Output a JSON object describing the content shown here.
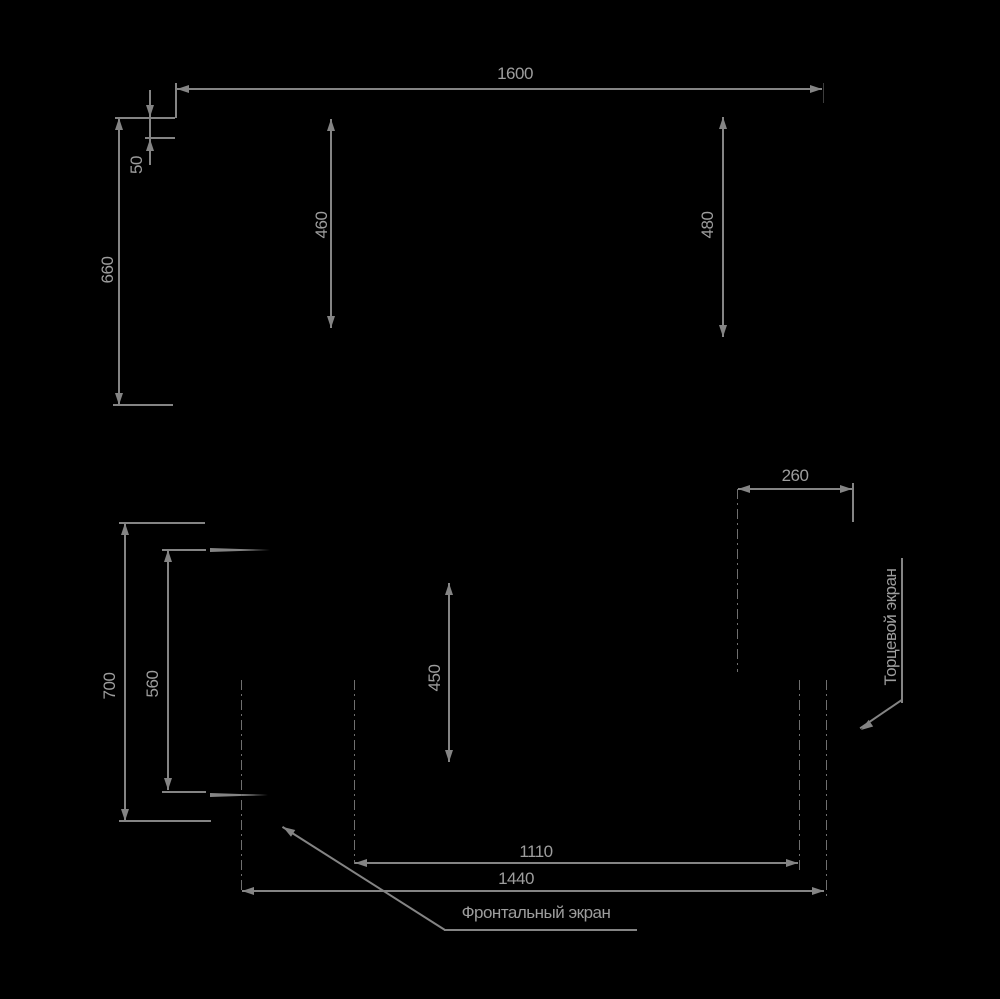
{
  "colors": {
    "background": "#000000",
    "line": "#848484",
    "text": "#9d9d9d"
  },
  "dimensions": {
    "top_width": "1600",
    "notch_height": "50",
    "upper_left_height": "660",
    "upper_inner_left_height": "460",
    "upper_inner_right_height": "480",
    "side_depth": "260",
    "lower_outer_height": "700",
    "lower_inner_height": "560",
    "lower_center_height": "450",
    "bottom_inner_width": "1110",
    "bottom_outer_width": "1440"
  },
  "labels": {
    "frontal_screen": "Фронтальный экран",
    "end_screen": "Торцевой экран"
  }
}
